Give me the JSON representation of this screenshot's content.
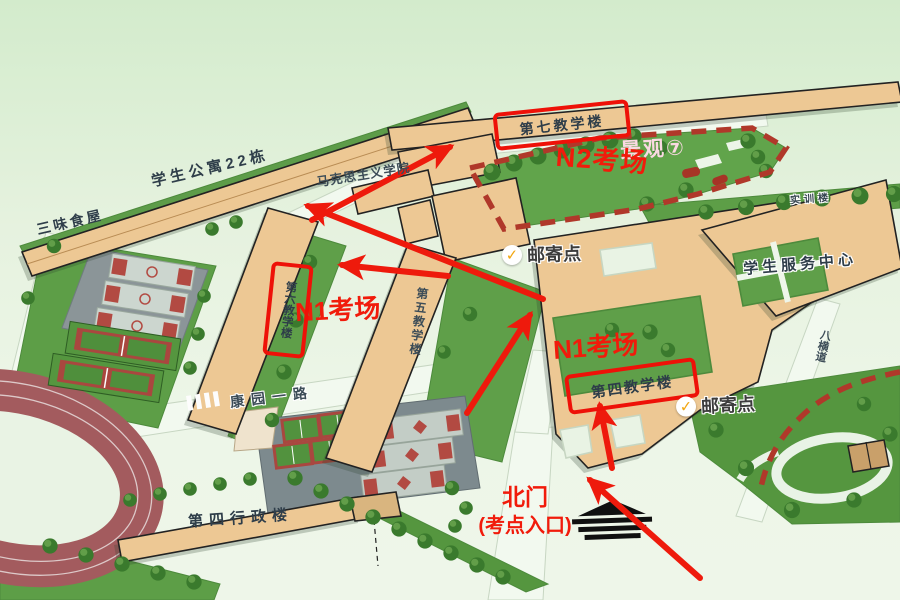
{
  "map": {
    "buildings": {
      "building7": "第七教学楼",
      "building6": "第六教学楼",
      "building5": "第五教学楼",
      "building4": "第四教学楼",
      "admin4": "第四行政楼",
      "apartment22": "学生公寓22栋",
      "sanwei_food": "三味食屋",
      "marxism_school": "马克思主义学院",
      "student_service_center": "学生服务中心",
      "training_building": "实训楼"
    },
    "annotations": {
      "n2_exam": "N2考场",
      "n1_exam_west": "N1考场",
      "n1_exam_east": "N1考场",
      "mail_point_1": "邮寄点",
      "mail_point_2": "邮寄点",
      "north_gate": "北门",
      "north_gate_sub": "(考点入口)"
    },
    "places": {
      "landscape7": "景观⑦",
      "kangyuan_road": "康园一路",
      "eight_cross_road": "八横道"
    },
    "icons": {
      "checkmark": "✓"
    },
    "colors": {
      "annotation_red": "#f11b0b",
      "box_red": "#ee1108",
      "hedge_red": "#b0382a",
      "check_orange": "#f2a712",
      "building_tan": "#edc894",
      "lawn_green": "#61a44b",
      "label_dark": "#2e3d49"
    }
  }
}
